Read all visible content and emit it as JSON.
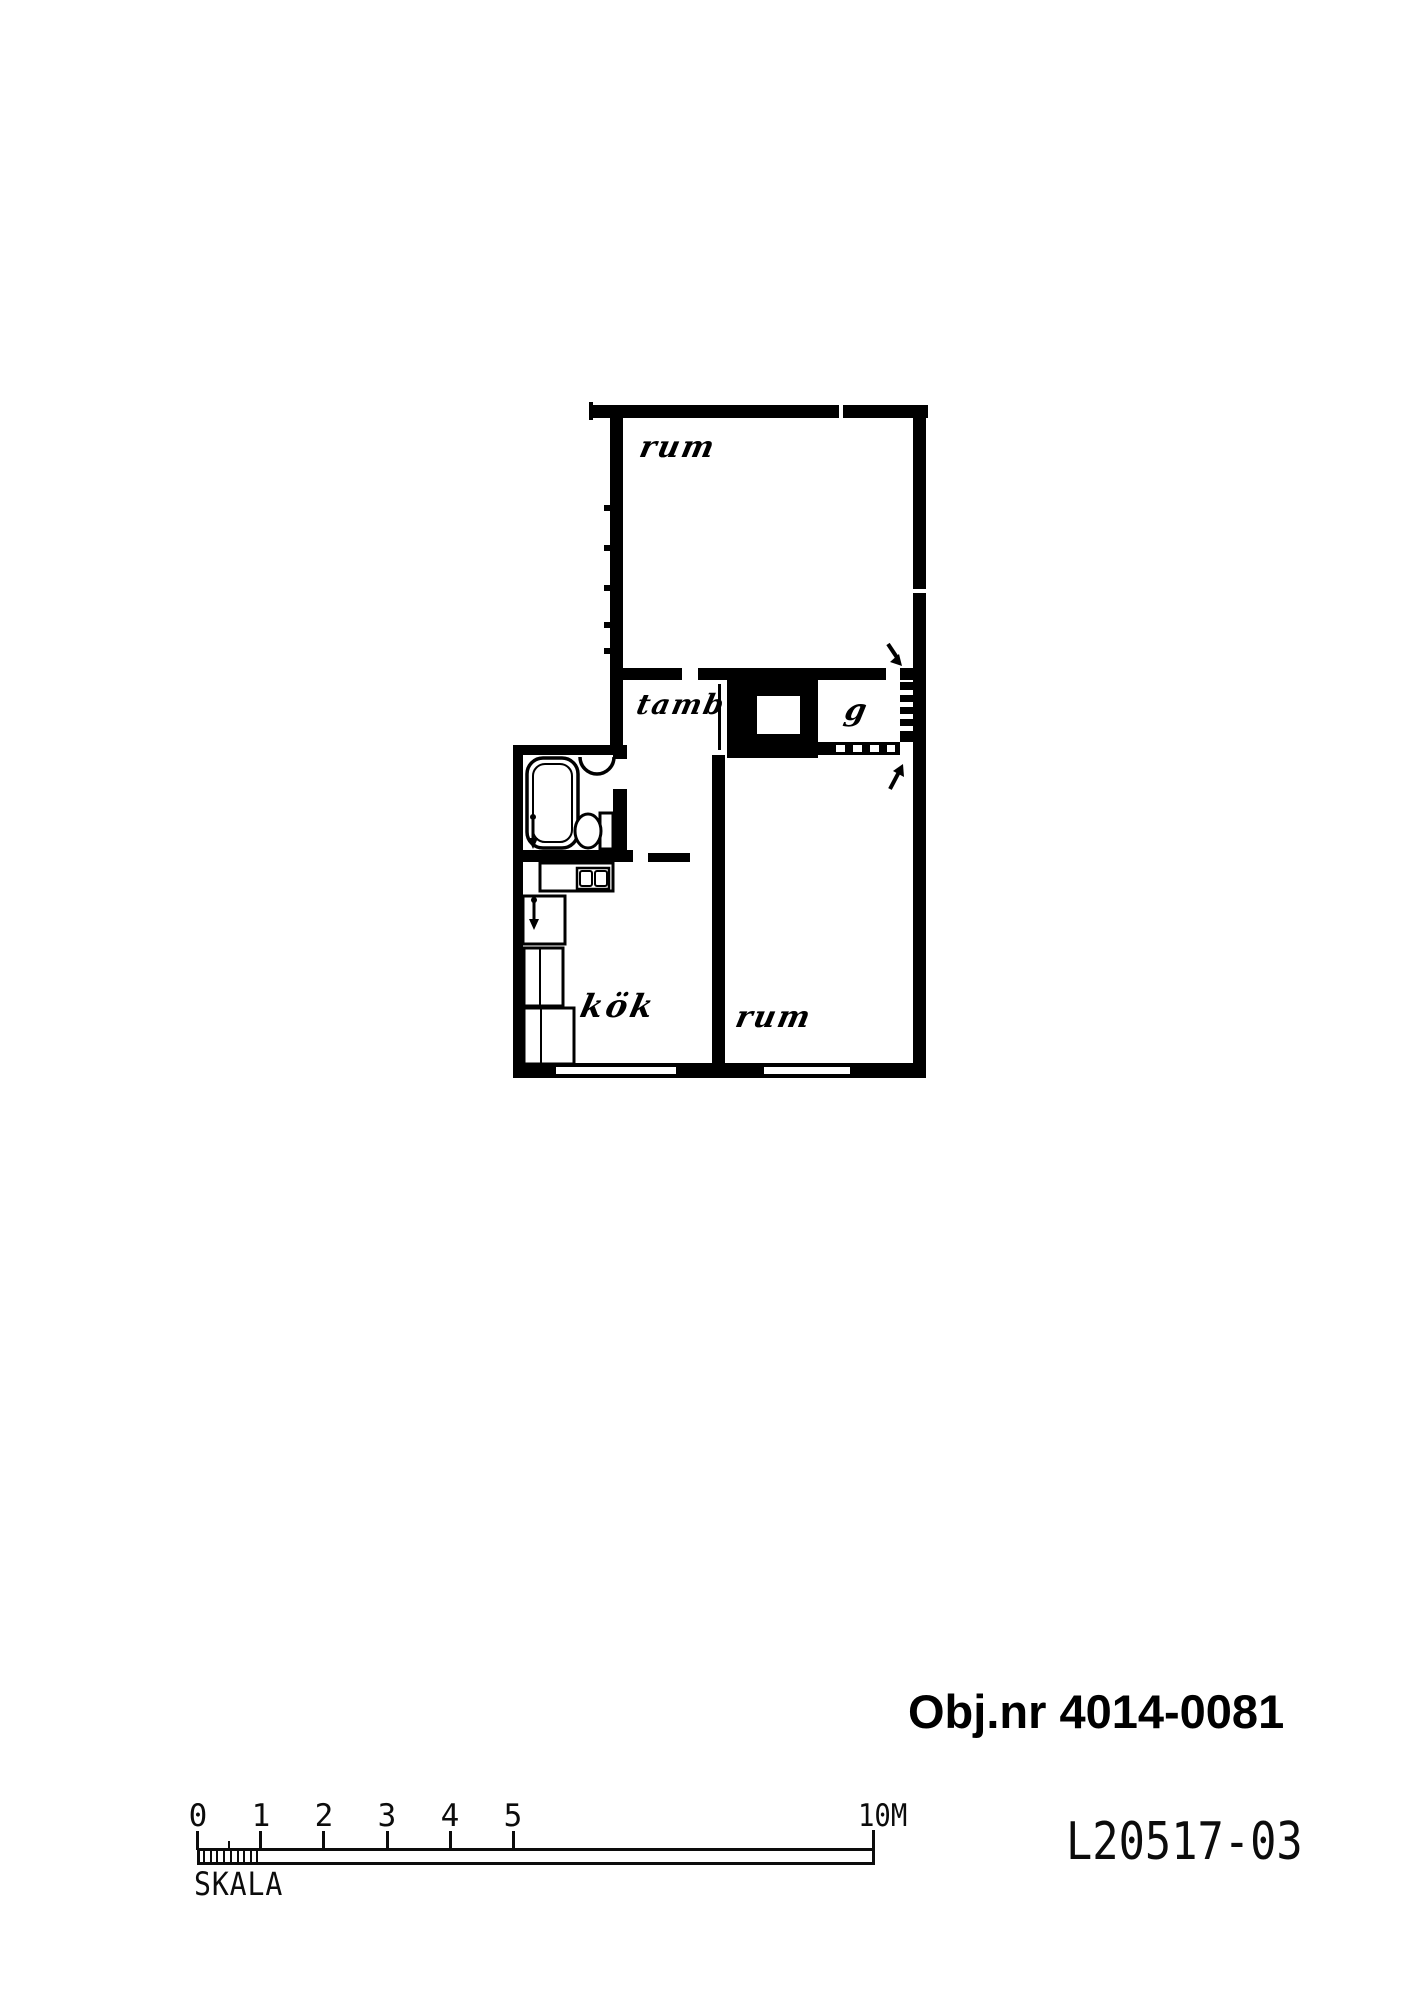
{
  "floor_plan": {
    "room_labels": {
      "top_room": "rum",
      "hall": "tamb",
      "closet": "g",
      "kitchen": "kök",
      "bottom_room": "rum"
    }
  },
  "annotations": {
    "object_number": "Obj.nr 4014-0081",
    "drawing_number": "L20517-03"
  },
  "scale_bar": {
    "title": "SKALA",
    "tick_labels": [
      "0",
      "1",
      "2",
      "3",
      "4",
      "5"
    ],
    "end_label": "10M"
  },
  "colors": {
    "ink": "#000000",
    "paper": "#ffffff"
  }
}
